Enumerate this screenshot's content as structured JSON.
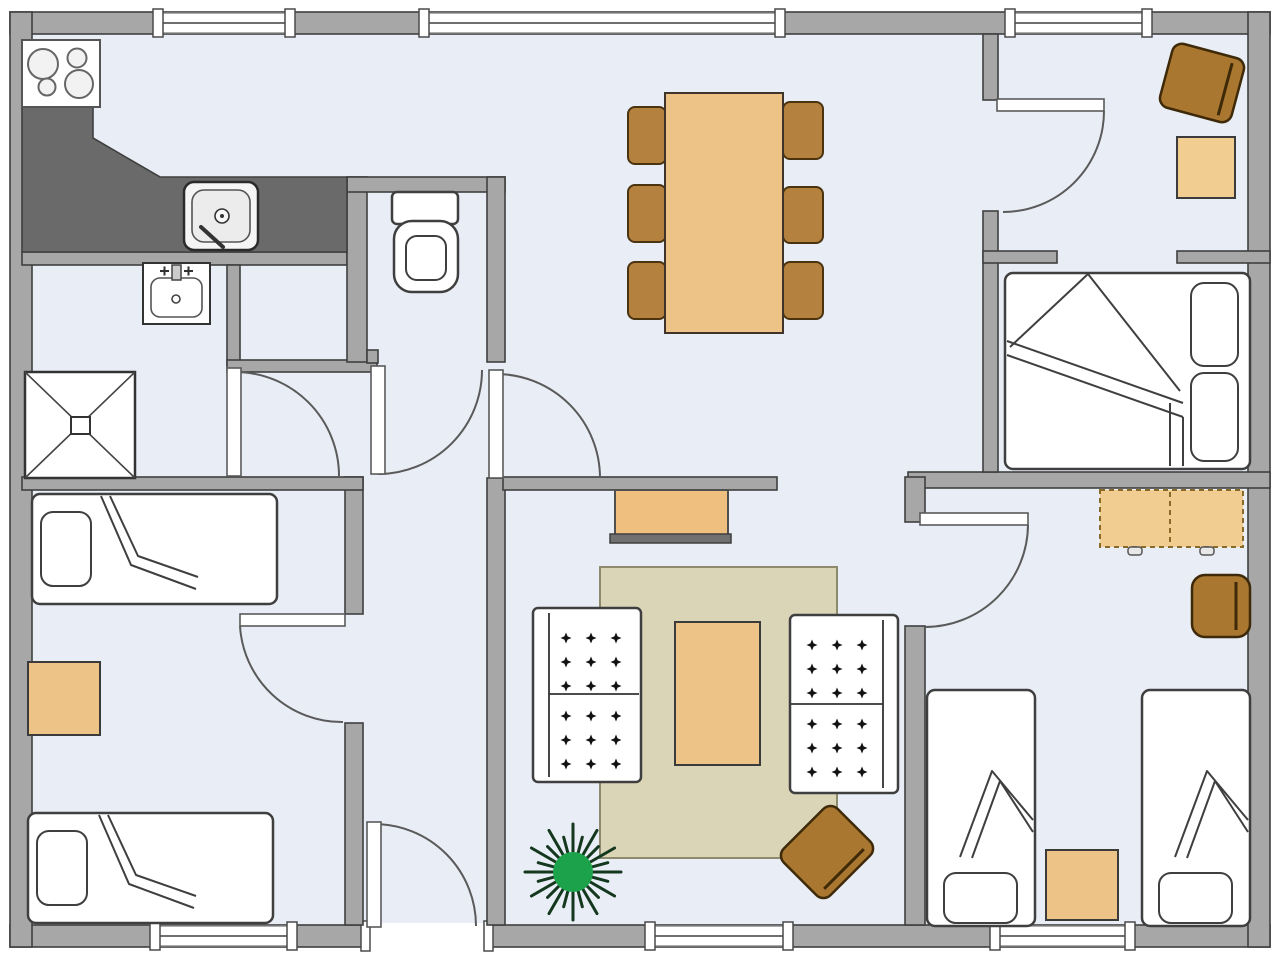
{
  "document": {
    "title": "Apartment floor plan"
  },
  "palette": {
    "floor": "#e9edf6",
    "outside": "#ffffff",
    "wall_fill": "#a7a7a7",
    "wall_stroke": "#3f3f3f",
    "counter_gray": "#6a6a6a",
    "fixture_white": "#ffffff",
    "wood_brown": "#b5813f",
    "wood_brown_dark": "#aa7730",
    "wood_tan": "#edc388",
    "wood_tan_light": "#f2cd92",
    "rug_beige": "#dbd5b8",
    "plant_green": "#1ba24b",
    "plant_spikes": "#14381d",
    "cushion_mark": "#111111"
  },
  "rooms": {
    "kitchen": {
      "name": "Kitchen"
    },
    "bathroom": {
      "name": "Bathroom with shower and washbasin"
    },
    "wc": {
      "name": "WC"
    },
    "storage": {
      "name": "Storage closet"
    },
    "hallway": {
      "name": "Hallway"
    },
    "dining": {
      "name": "Dining area"
    },
    "living": {
      "name": "Living room"
    },
    "bedroom_left": {
      "name": "Bedroom bottom left"
    },
    "room_top_right": {
      "name": "Room top right"
    },
    "bedroom_mid_right": {
      "name": "Bedroom middle right"
    },
    "bedroom_bottom_right": {
      "name": "Bedroom bottom right with two beds"
    }
  },
  "furniture": [
    {
      "id": "stove",
      "name": "Cooktop with four burners",
      "room": "kitchen"
    },
    {
      "id": "kitchen-counter",
      "name": "L-shaped kitchen counter",
      "room": "kitchen"
    },
    {
      "id": "kitchen-sink",
      "name": "Kitchen sink",
      "room": "kitchen"
    },
    {
      "id": "washbasin",
      "name": "Washbasin",
      "room": "bathroom"
    },
    {
      "id": "shower",
      "name": "Shower tray",
      "room": "bathroom"
    },
    {
      "id": "toilet",
      "name": "Toilet",
      "room": "wc"
    },
    {
      "id": "dining-table",
      "name": "Dining table",
      "room": "dining"
    },
    {
      "id": "dining-chair",
      "name": "Dining chair",
      "room": "dining"
    },
    {
      "id": "sideboard",
      "name": "Sideboard",
      "room": "living"
    },
    {
      "id": "rug",
      "name": "Area rug",
      "room": "living"
    },
    {
      "id": "coffee-table",
      "name": "Coffee table",
      "room": "living"
    },
    {
      "id": "sofa",
      "name": "Two-cushion sofa",
      "room": "living"
    },
    {
      "id": "armchair",
      "name": "Armchair",
      "room": "living"
    },
    {
      "id": "plant",
      "name": "Potted plant",
      "room": "living"
    },
    {
      "id": "single-bed",
      "name": "Single bed with pillow and folded blanket",
      "room": "bedroom_left"
    },
    {
      "id": "double-bed",
      "name": "Double bed with two pillows",
      "room": "bedroom_mid_right"
    },
    {
      "id": "wardrobe",
      "name": "Wardrobe (dashed outline)",
      "room": "bedroom_bottom_right"
    },
    {
      "id": "nightstand",
      "name": "Nightstand",
      "room": "bedroom_bottom_right"
    },
    {
      "id": "side-table",
      "name": "Side table",
      "room": "bedroom_left"
    },
    {
      "id": "desk-chair",
      "name": "Upholstered chair",
      "room": "room_top_right"
    },
    {
      "id": "side-table-top-right",
      "name": "Square table",
      "room": "room_top_right"
    }
  ],
  "counts": {
    "windows_top_wall": 3,
    "windows_bottom_wall": 3,
    "interior_doors": 6,
    "entrance_doors": 1,
    "beds": 5,
    "sofas": 2,
    "dining_chairs": 6,
    "armchairs": 3
  }
}
